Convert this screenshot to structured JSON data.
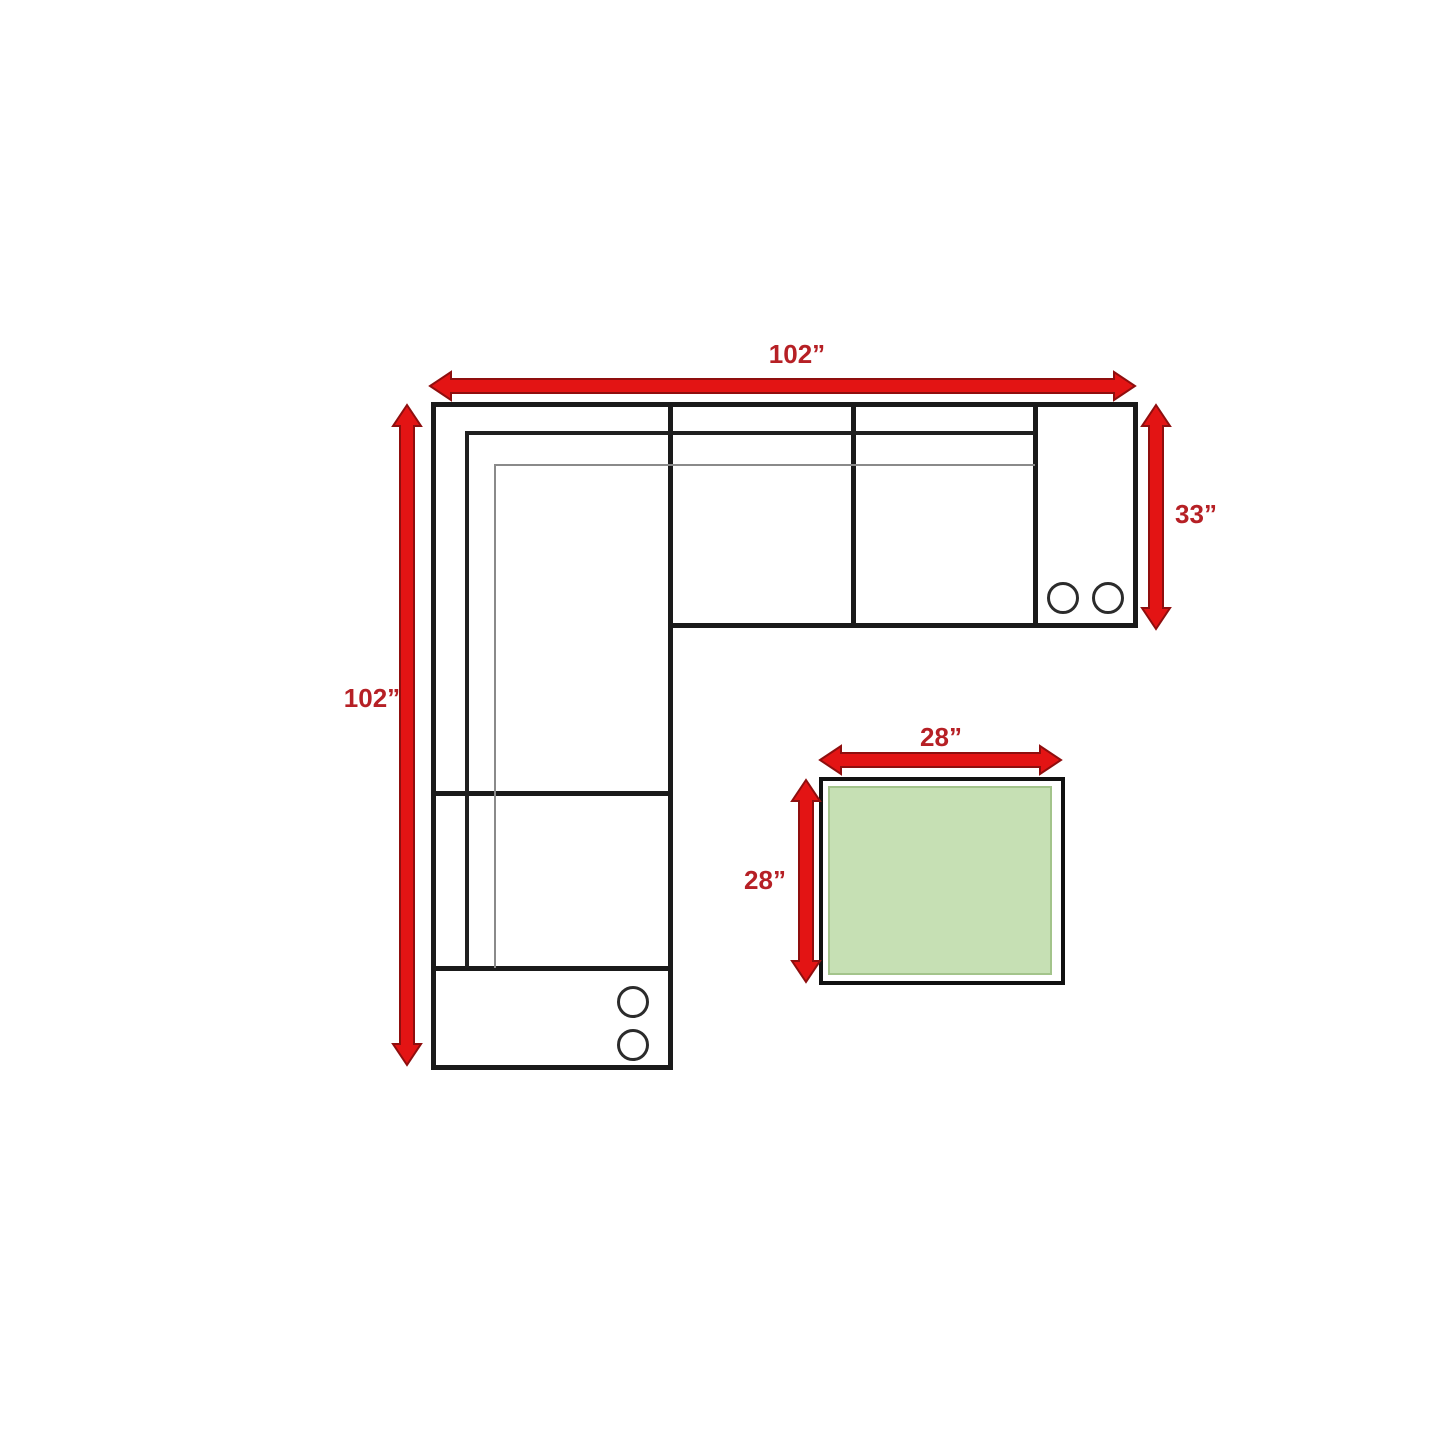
{
  "diagram": {
    "kind": "sectional-sofa-with-ottoman-floor-plan"
  },
  "measurements": {
    "sofa_width": "102”",
    "sofa_depth": "102”",
    "sofa_right_depth": "33”",
    "ottoman_width": "28”",
    "ottoman_depth": "28”"
  },
  "colors": {
    "arrow-red": "#E31414",
    "arrow-edge": "#8F0E0E",
    "label-red": "#B62025",
    "outline-black": "#1A1A1A",
    "seam-gray": "#8A8A8A",
    "ottoman-green": "#C6E0B4",
    "ottoman-green-edge": "#A3C48B"
  }
}
